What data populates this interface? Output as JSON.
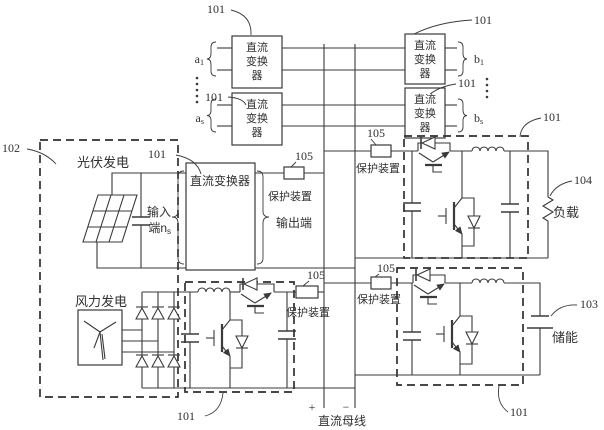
{
  "figure": {
    "colors": {
      "line": "#3a3a3a",
      "background": "#ffffff"
    },
    "refs": {
      "converter": "101",
      "sources": "102",
      "storage": "103",
      "load": "104",
      "protection": "105"
    },
    "labels": {
      "pv_source": "光伏发电",
      "wind_source": "风力发电",
      "dc_converter": "直流变换器",
      "dc_converter_l1": "直流",
      "dc_converter_l2": "变换",
      "dc_converter_l3": "器",
      "protection_device": "保护装置",
      "input_l1": "输入",
      "input_l2": "端n",
      "output_terminal": "输出端",
      "load": "负载",
      "storage": "储能",
      "dc_bus": "直流母线",
      "plus": "+",
      "minus": "−",
      "a": "a",
      "b": "b",
      "sub_1": "1",
      "sub_s": "s"
    }
  }
}
